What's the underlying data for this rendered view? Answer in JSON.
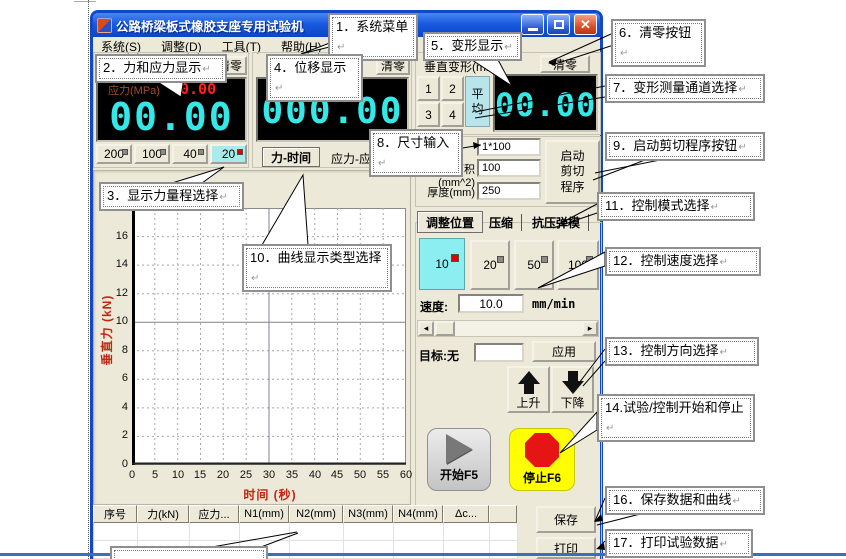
{
  "window": {
    "title": "公路桥梁板式橡胶支座专用试验机",
    "menu": [
      "系统(S)",
      "调整(D)",
      "工具(T)",
      "帮助(H)"
    ],
    "force_panel": {
      "clear_label": "清零",
      "stress_label": "应力(MPa)",
      "stress_value": "0.00",
      "value": "00.00",
      "ranges": [
        "200",
        "100",
        "40",
        "20"
      ],
      "selected_range": "20"
    },
    "displacement_panel": {
      "clear_label": "清零",
      "value": "000.00",
      "tab_force_time": "力-时间",
      "tab_stress_strain": "应力-应"
    },
    "deformation_panel": {
      "title": "垂直变形(mm)",
      "clear_label": "清零",
      "channels": [
        "1",
        "2",
        "3",
        "4"
      ],
      "average_label": "平均",
      "value": "00.00"
    },
    "size_panel": {
      "size_value": "1*100",
      "area_label": "面积(mm^2)",
      "area_value": "100",
      "thickness_label": "厚度(mm)",
      "thickness_value": "250",
      "shear_button_label": "启动\n剪切\n程序"
    },
    "control_panel": {
      "tabs": [
        "调整位置",
        "压缩",
        "抗压弹模"
      ],
      "active_tab": "调整位置",
      "speed_options": [
        "10",
        "20",
        "50",
        "100"
      ],
      "selected_speed": "10",
      "speed_label": "速度:",
      "speed_value": "10.0",
      "speed_unit": "mm/min",
      "target_label": "目标:无",
      "target_value": "",
      "apply_label": "应用",
      "up_label": "上升",
      "down_label": "下降",
      "start_label": "开始F5",
      "stop_label": "停止F6"
    },
    "table_headers": [
      "序号",
      "力(kN)",
      "应力...",
      "N1(mm)",
      "N2(mm)",
      "N3(mm)",
      "N4(mm)",
      "Δc..."
    ],
    "save_label": "保存",
    "print_label": "打印"
  },
  "chart_data": {
    "type": "line",
    "title": "",
    "xlabel": "时间  (秒)",
    "ylabel": "垂直力 (kN)",
    "x_ticks": [
      "0",
      "5",
      "10",
      "15",
      "20",
      "25",
      "30",
      "35",
      "40",
      "45",
      "50",
      "55",
      "60"
    ],
    "y_ticks": [
      "0",
      "2",
      "4",
      "6",
      "8",
      "10",
      "12",
      "14",
      "16",
      "18"
    ],
    "xlim": [
      0,
      60
    ],
    "ylim": [
      0,
      18
    ],
    "grid": "dashed",
    "series": []
  },
  "callouts": [
    {
      "id": "1",
      "label": "1．系统菜单"
    },
    {
      "id": "2",
      "label": "2．力和应力显示"
    },
    {
      "id": "3",
      "label": "3．显示力量程选择"
    },
    {
      "id": "4",
      "label": "4．位移显示"
    },
    {
      "id": "5",
      "label": "5．变形显示"
    },
    {
      "id": "6",
      "label": "6．清零按钮"
    },
    {
      "id": "7",
      "label": "7．变形测量通道选择"
    },
    {
      "id": "8",
      "label": "8．尺寸输入"
    },
    {
      "id": "9",
      "label": "9．启动剪切程序按钮"
    },
    {
      "id": "10",
      "label": "10．曲线显示类型选择"
    },
    {
      "id": "11",
      "label": "11．控制模式选择"
    },
    {
      "id": "12",
      "label": "12．控制速度选择"
    },
    {
      "id": "13",
      "label": "13．控制方向选择"
    },
    {
      "id": "14",
      "label": "14.试验/控制开始和停止"
    },
    {
      "id": "16",
      "label": "16．保存数据和曲线"
    },
    {
      "id": "17",
      "label": "17．打印试验数据"
    }
  ],
  "marks": {
    "pilcrow": "↵"
  }
}
